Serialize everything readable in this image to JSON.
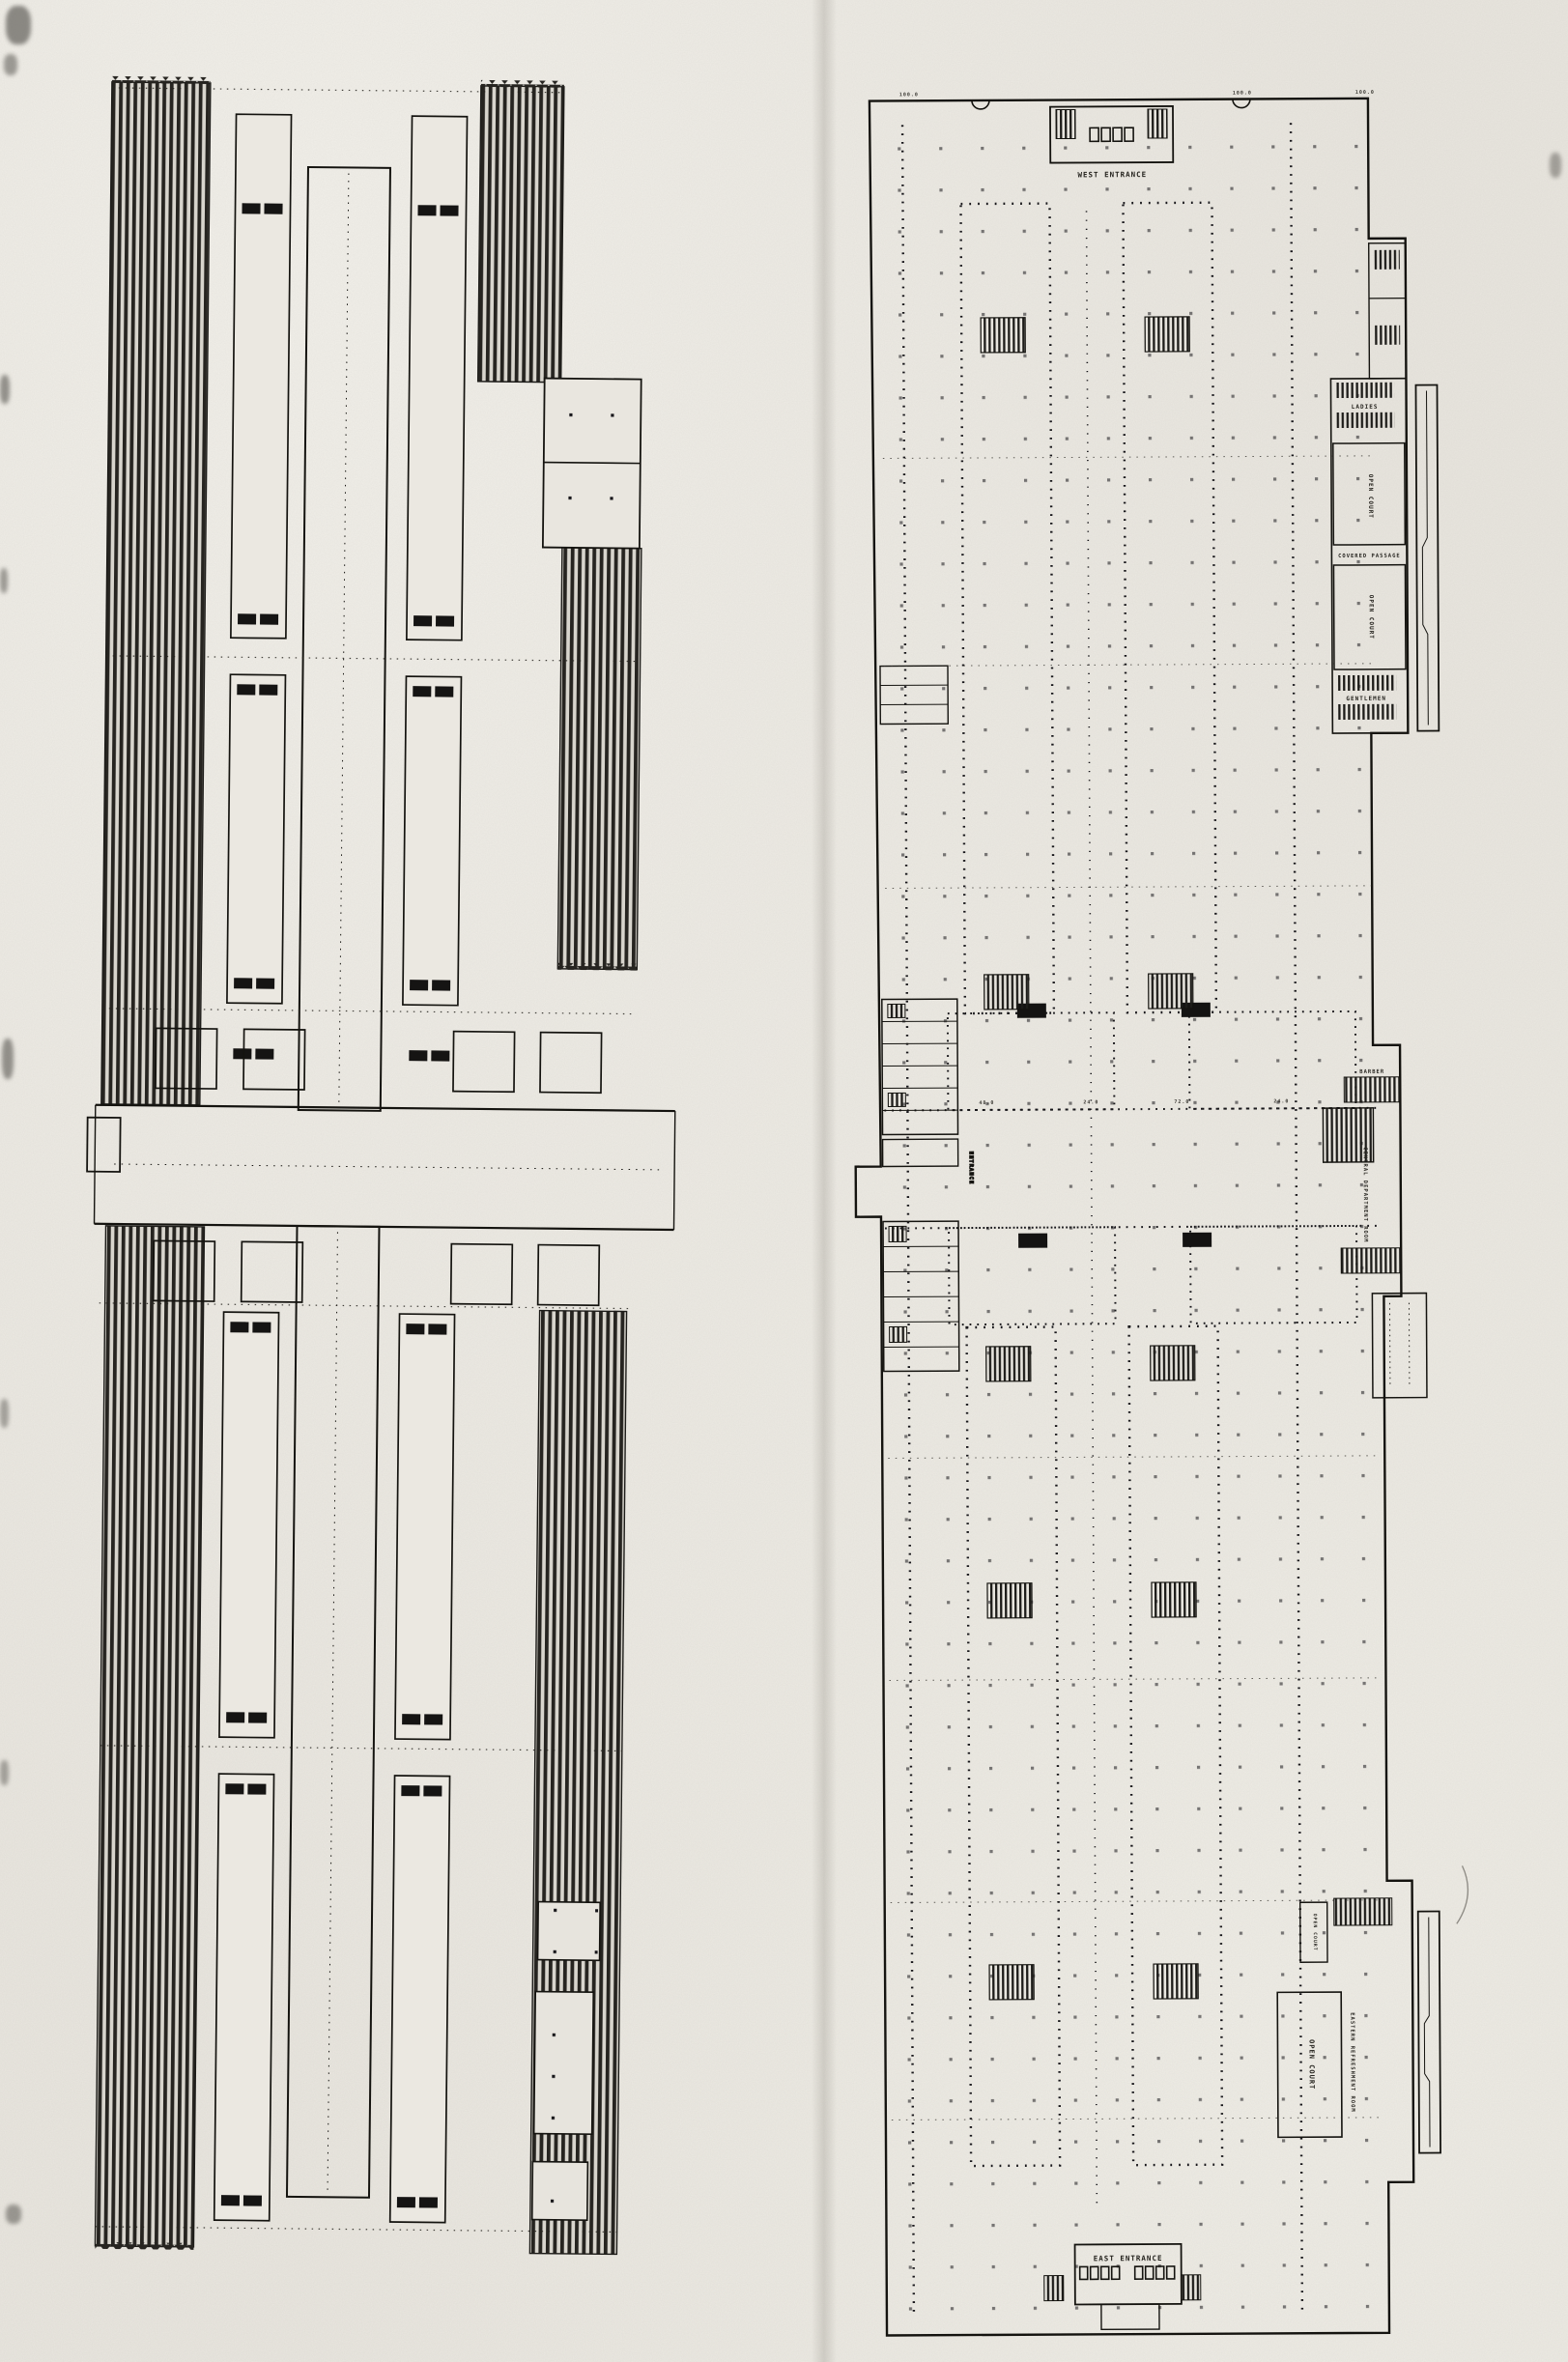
{
  "document": {
    "kind": "scanned architectural floor plans, two elongated plans side by side",
    "paper_color": "#e9e6df",
    "ink_color": "#26241f"
  },
  "left_plan": {
    "description": "gallery / roof plan with dark hatched bands, long halls and cruciform central court",
    "labels": {}
  },
  "right_plan": {
    "description": "ground floor plan with column grid, courts and entrances",
    "labels": {
      "west_entrance": "WEST ENTRANCE",
      "east_entrance": "EAST ENTRANCE",
      "ladies": "LADIES",
      "gentlemen": "GENTLEMEN",
      "open_court_1": "OPEN COURT",
      "open_court_2": "OPEN COURT",
      "open_court_3": "OPEN COURT",
      "open_court_4": "OPEN COURT",
      "covered_passage": "COVERED PASSAGE",
      "central_department": "CENTRAL DEPARTMENT ROOM",
      "barber": "BARBER",
      "eastern_refreshment": "EASTERN REFRESHMENT ROOM",
      "side_entrance": "ENTRANCE"
    },
    "dims": [
      "100.0",
      "100.0",
      "48.0",
      "24.0",
      "72.0",
      "24.0",
      "100.0"
    ]
  }
}
